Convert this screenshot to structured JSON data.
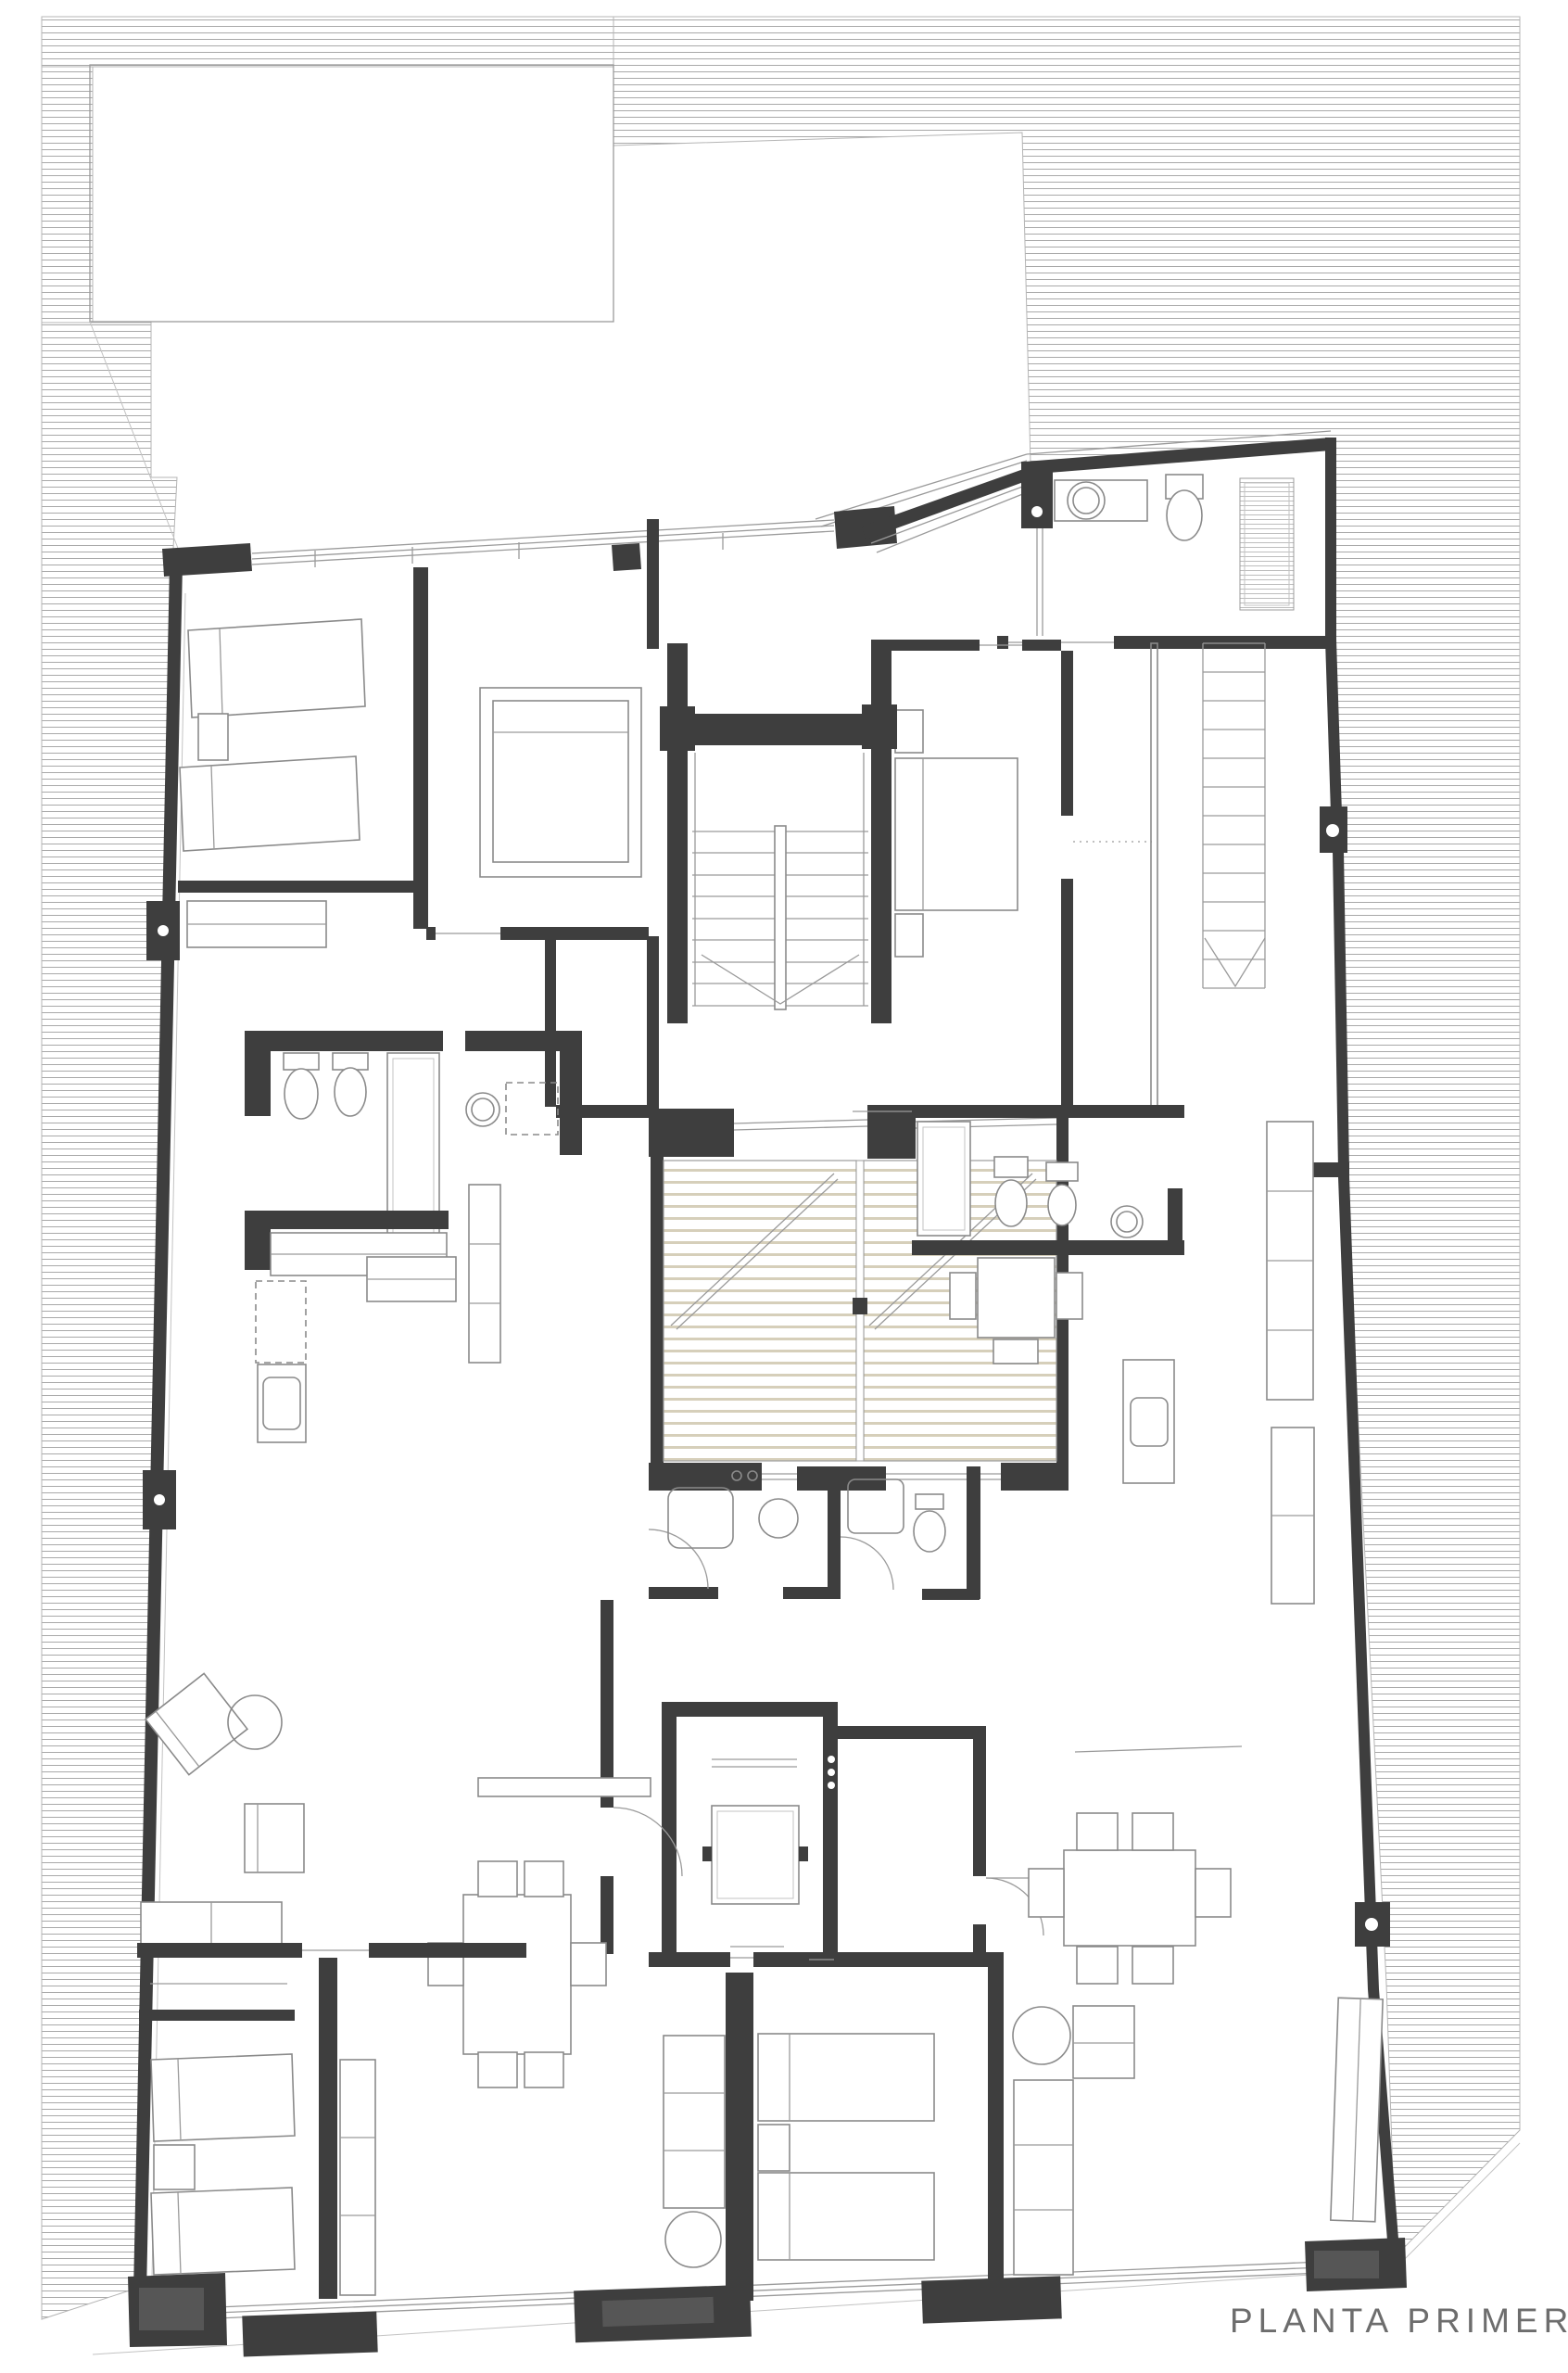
{
  "title": {
    "label": "PLANTA PRIMERA"
  },
  "colors": {
    "wall": "#3e3e3e",
    "hatch_line": "#a9a9a9",
    "patio_line": "#d6cfba",
    "furniture_line": "#8a8a8a",
    "thin_line": "#9a9a9a",
    "label": "#6d6d6d",
    "background": "#ffffff"
  }
}
